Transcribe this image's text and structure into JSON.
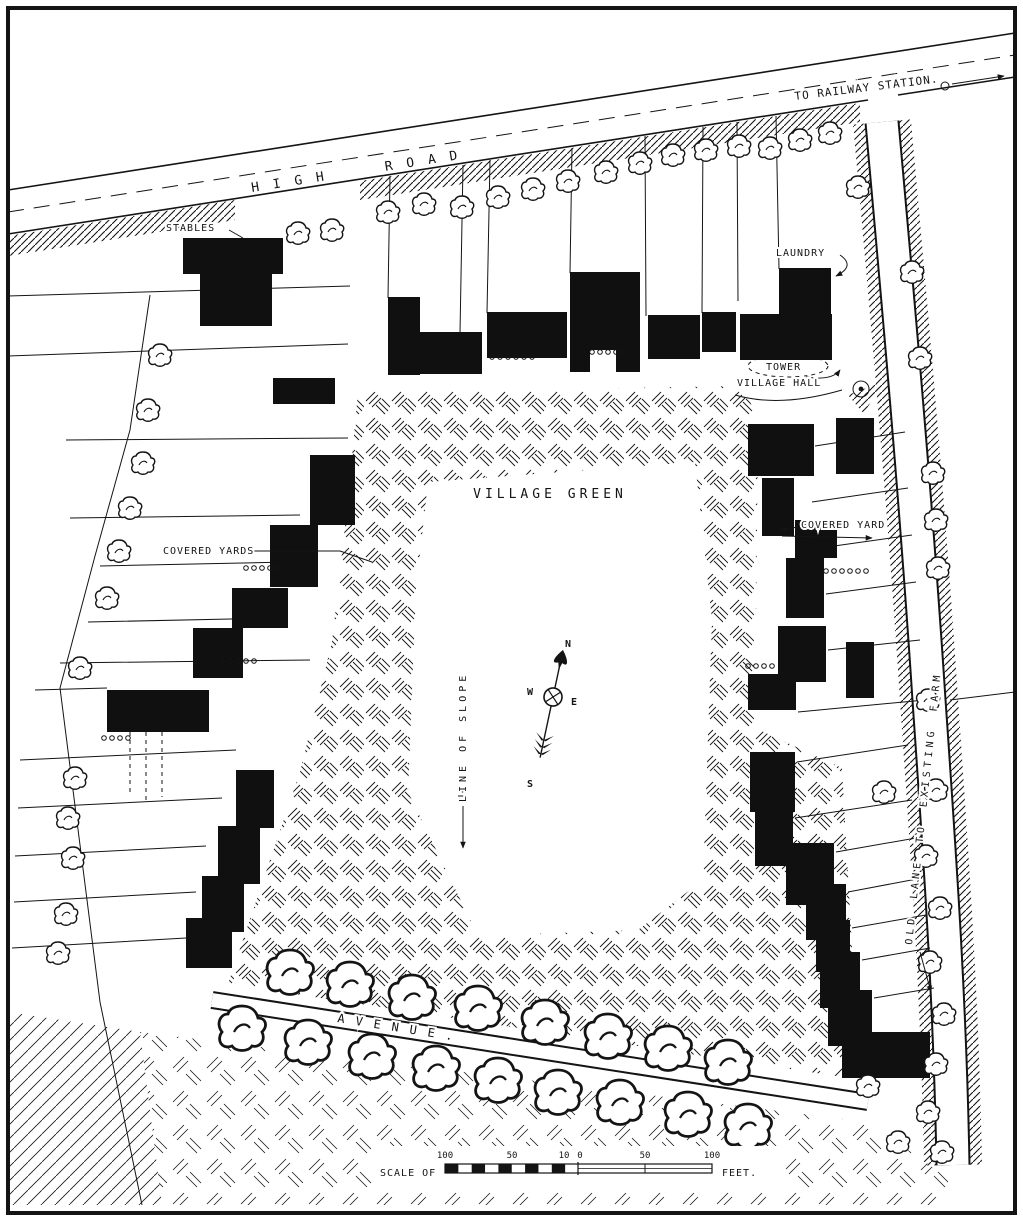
{
  "map": {
    "labels": {
      "to_railway_station": "TO RAILWAY STATION.",
      "high_road": "HIGH ROAD",
      "stables": "STABLES",
      "laundry": "LAUNDRY",
      "tower": "TOWER",
      "village_hall": "VILLAGE HALL",
      "village_green": "VILLAGE GREEN",
      "covered_yards_left": "COVERED YARDS",
      "covered_yard_right": "COVERED YARD",
      "avenue": "AVENUE.",
      "line_of_slope": "LINE OF SLOPE",
      "old_lane": "OLD LANE TO EXISTING FARM"
    },
    "compass": {
      "north": "N",
      "east": "E",
      "south": "S",
      "west": "W"
    },
    "scale_bar": {
      "prefix": "SCALE OF",
      "suffix": "FEET.",
      "ticks": [
        "100",
        "50",
        "10",
        "0",
        "50",
        "100"
      ]
    },
    "colors": {
      "ink": "#141414",
      "paper": "#ffffff"
    }
  }
}
